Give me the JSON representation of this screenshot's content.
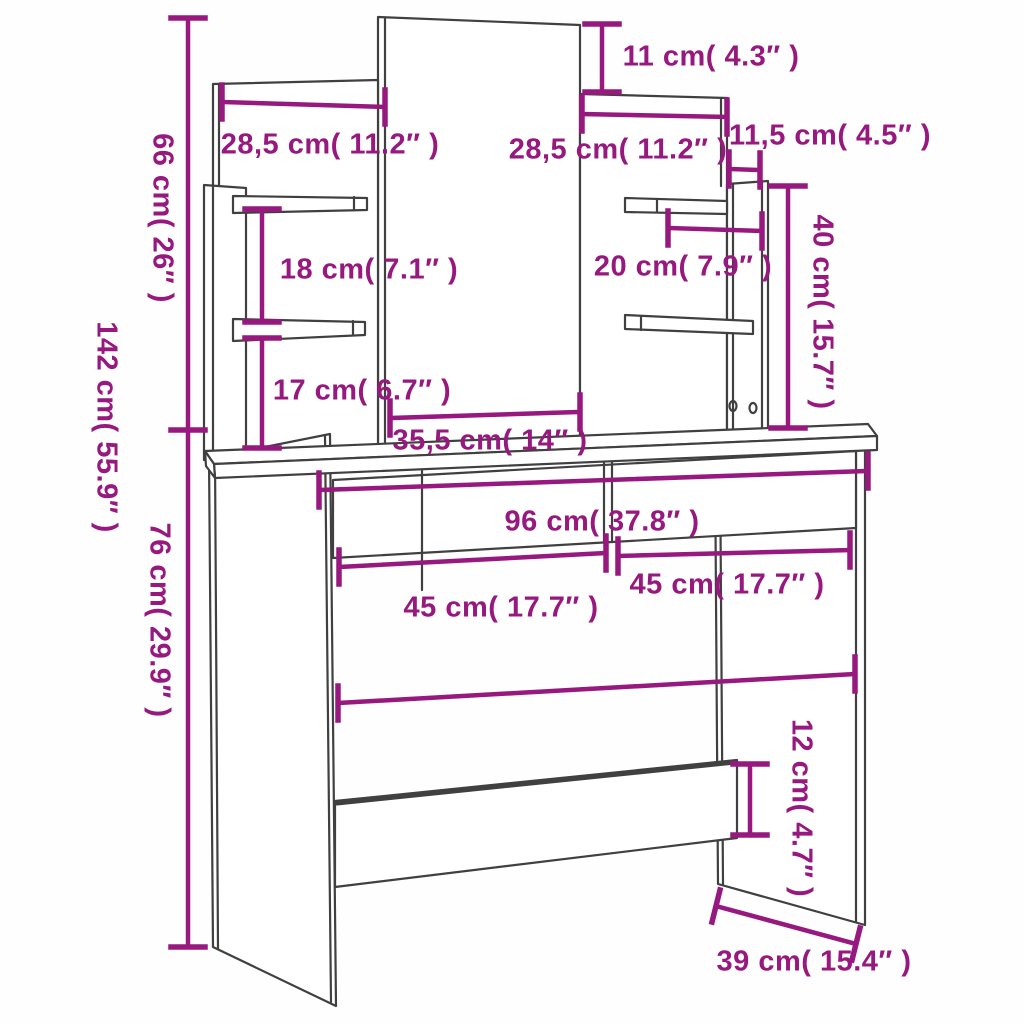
{
  "colors": {
    "dimension": "#97187E",
    "outline": "#404040",
    "background": "#fefefe"
  },
  "dimensions": {
    "total_height": {
      "label": "142 cm( 55.9″ )",
      "cm": "142",
      "inches": "55.9"
    },
    "upper_height": {
      "label": "66 cm( 26″ )",
      "cm": "66",
      "inches": "26"
    },
    "desk_height": {
      "label": "76 cm( 29.9″ )",
      "cm": "76",
      "inches": "29.9"
    },
    "mirror_offset_top": {
      "label": "11 cm( 4.3″ )",
      "cm": "11",
      "inches": "4.3"
    },
    "left_panel_width": {
      "label": "28,5 cm( 11.2″ )",
      "cm": "28,5",
      "inches": "11.2"
    },
    "right_panel_width": {
      "label": "28,5 cm( 11.2″ )",
      "cm": "28,5",
      "inches": "11.2"
    },
    "side_board_depth": {
      "label": "11,5 cm( 4.5″ )",
      "cm": "11,5",
      "inches": "4.5"
    },
    "right_column_height": {
      "label": "40 cm( 15.7″ )",
      "cm": "40",
      "inches": "15.7"
    },
    "left_shelf_gap": {
      "label": "18 cm( 7.1″ )",
      "cm": "18",
      "inches": "7.1"
    },
    "right_shelf_width": {
      "label": "20 cm( 7.9″ )",
      "cm": "20",
      "inches": "7.9"
    },
    "left_lower_gap": {
      "label": "17 cm( 6.7″ )",
      "cm": "17",
      "inches": "6.7"
    },
    "mirror_width": {
      "label": "35,5 cm( 14″ )",
      "cm": "35,5",
      "inches": "14"
    },
    "desk_width": {
      "label": "96 cm( 37.8″ )",
      "cm": "96",
      "inches": "37.8"
    },
    "left_drawer_width": {
      "label": "45 cm( 17.7″ )",
      "cm": "45",
      "inches": "17.7"
    },
    "right_drawer_width": {
      "label": "45 cm( 17.7″ )",
      "cm": "45",
      "inches": "17.7"
    },
    "rail_height": {
      "label": "12 cm( 4.7″ )",
      "cm": "12",
      "inches": "4.7"
    },
    "desk_depth": {
      "label": "39 cm( 15.4″ )",
      "cm": "39",
      "inches": "15.4"
    }
  }
}
